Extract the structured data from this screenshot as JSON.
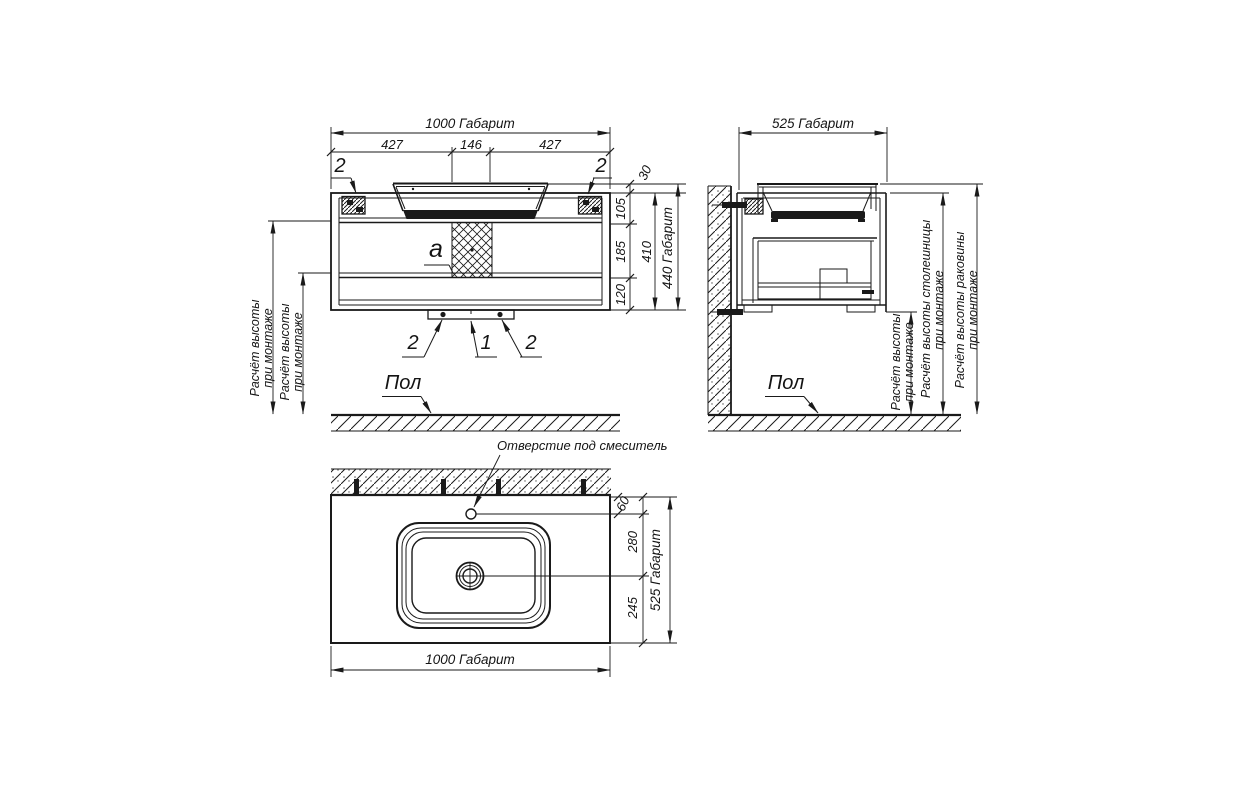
{
  "front_view": {
    "dim_width_total": "1000 Габарит",
    "dim_width_left": "427",
    "dim_width_center": "146",
    "dim_width_right": "427",
    "dim_30": "30",
    "dim_105": "105",
    "dim_185": "185",
    "dim_120": "120",
    "dim_410": "410",
    "dim_height_total": "440 Габарит",
    "callout_top_left": "2",
    "callout_top_right": "2",
    "callout_bottom_left": "2",
    "callout_bottom_center": "1",
    "callout_bottom_right": "2",
    "detail_label": "a",
    "mount_height_outer": {
      "line1": "Расчёт высоты",
      "line2": "при монтаже"
    },
    "mount_height_inner": {
      "line1": "Расчёт высоты",
      "line2": "при монтаже"
    },
    "floor_label": "Пол"
  },
  "side_view": {
    "dim_depth_total": "525 Габарит",
    "mount_height": {
      "line1": "Расчёт высоты",
      "line2": "при монтаже"
    },
    "countertop_height": {
      "line1": "Расчёт высоты столешницы",
      "line2": "при монтаже"
    },
    "sink_height": {
      "line1": "Расчёт высоты раковины",
      "line2": "при монтаже"
    },
    "floor_label": "Пол"
  },
  "top_view": {
    "faucet_hole_label": "Отверстие под смеситель",
    "dim_60": "60",
    "dim_280": "280",
    "dim_245": "245",
    "dim_depth_total": "525 Габарит",
    "dim_width_total": "1000 Габарит"
  },
  "colors": {
    "line": "#1a1a1a",
    "background": "#ffffff"
  }
}
